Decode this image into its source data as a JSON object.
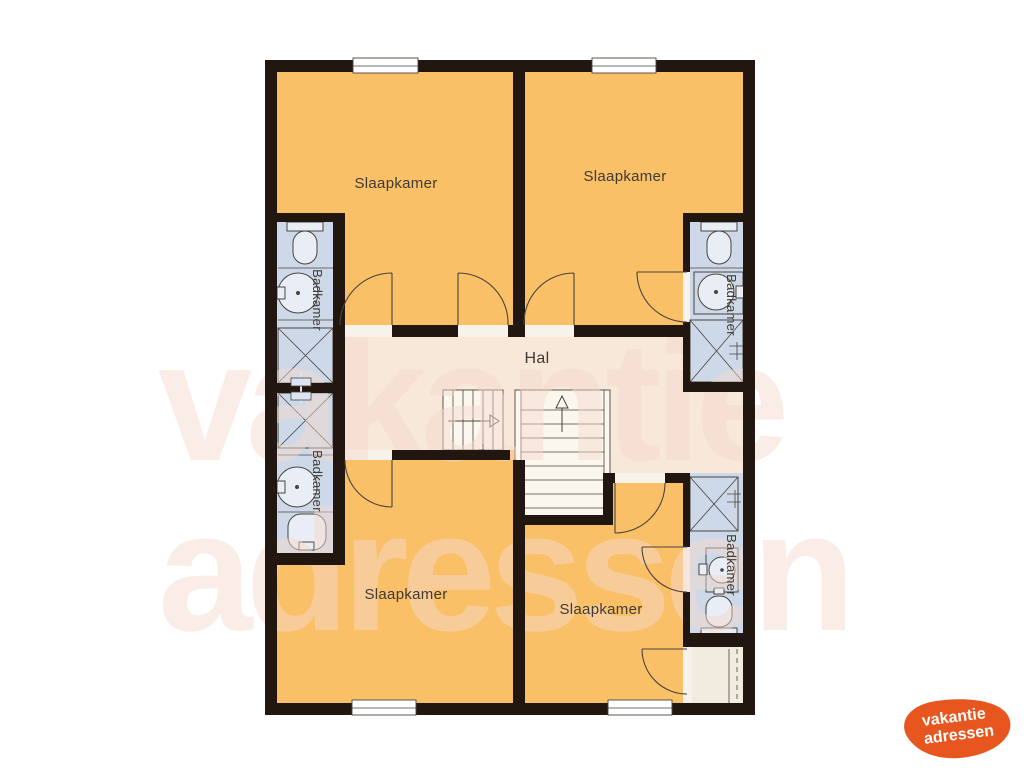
{
  "page": {
    "background": "#ffffff"
  },
  "plan": {
    "rooms": {
      "bedroom_top_left": {
        "label": "Slaapkamer"
      },
      "bedroom_top_right": {
        "label": "Slaapkamer"
      },
      "bedroom_bottom_left": {
        "label": "Slaapkamer"
      },
      "bedroom_bottom_right": {
        "label": "Slaapkamer"
      },
      "hall": {
        "label": "Hal"
      },
      "bathroom_top_left": {
        "label": "Badkamer"
      },
      "bathroom_mid_left": {
        "label": "Badkamer"
      },
      "bathroom_top_right": {
        "label": "Badkamer"
      },
      "bathroom_bottom_right": {
        "label": "Badkamer"
      }
    }
  },
  "watermark": {
    "line1": "vakantie",
    "line2": "adressen"
  },
  "logo": {
    "line1": "vakantie",
    "line2": "adressen"
  },
  "colors": {
    "bedroom": "#f9c068",
    "hall": "#f7e8da",
    "bathroom": "#cdd9e9",
    "fixture": "#e9eef6",
    "wall": "#221710",
    "line": "#4a443c",
    "stairs": "#fbf7ef",
    "closet": "#f2ebdf",
    "threshold": "#f8f3ea",
    "watermark": "#f6d9cc",
    "logo": "#e8561f",
    "label": "#403a33"
  }
}
